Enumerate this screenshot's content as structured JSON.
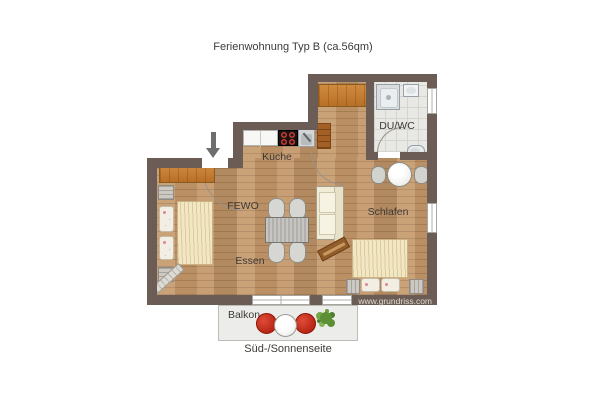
{
  "title": "Ferienwohnung Typ B (ca.56qm)",
  "rooms": {
    "kitchen": "Küche",
    "apartment": "FEWO",
    "dining": "Essen",
    "bedroom": "Schlafen",
    "bathroom": "DU/WC",
    "balcony": "Balkon"
  },
  "caption": "Süd-/Sonnenseite",
  "watermark": "www.grundriss.com",
  "icons": {
    "entrance_arrow": "arrow-down",
    "plant": "potted-plant",
    "shower": "shower-tray",
    "wc": "toilet",
    "washbasin": "sink"
  },
  "palette": {
    "wall": "#6b5d56",
    "wood_floor": "#c49769",
    "tile_floor": "#e8e8e4",
    "furniture_wood": "#c97f35",
    "balcony_chair_red": "#c1271b",
    "plant_green": "#699b3f",
    "bedding": "#f2e7c4"
  }
}
